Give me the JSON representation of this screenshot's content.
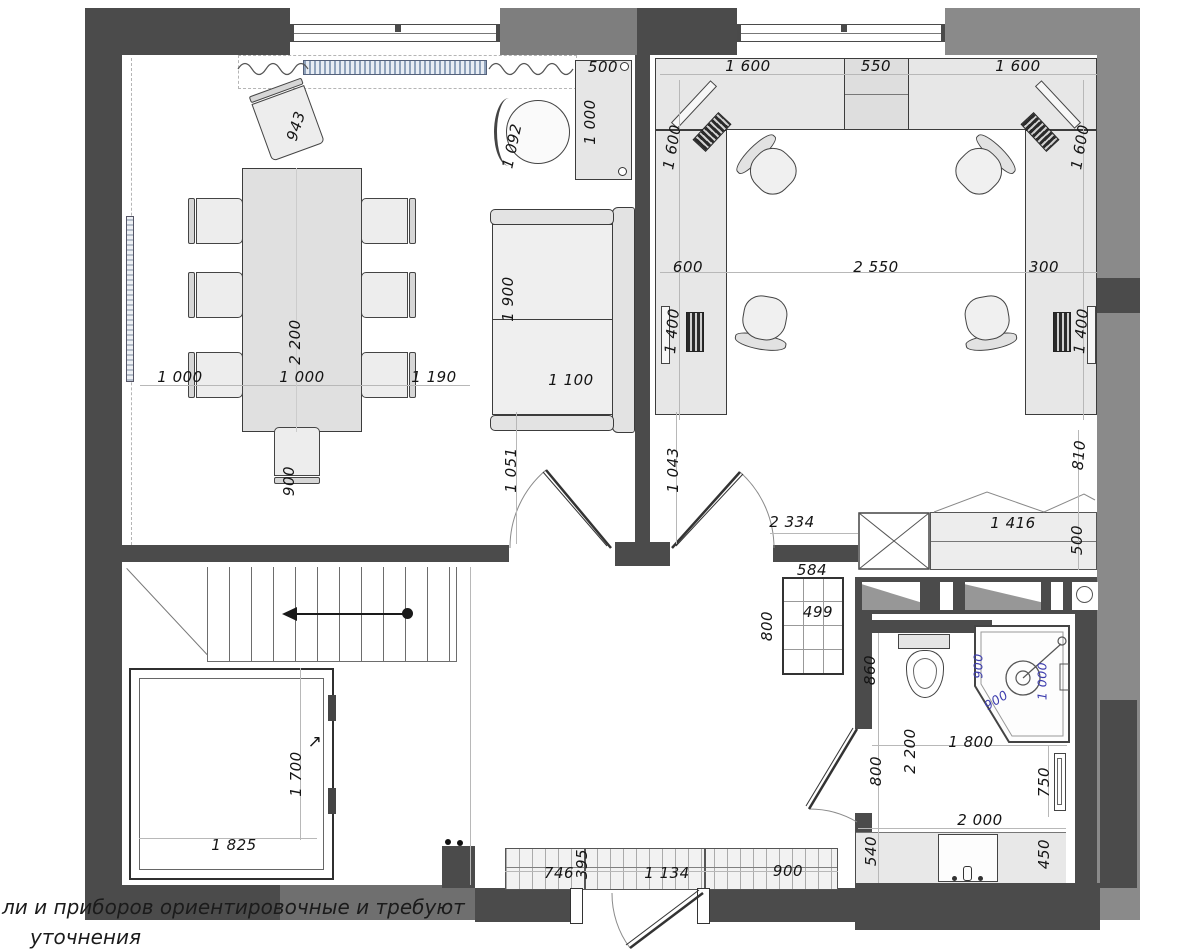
{
  "note": {
    "line1": "ли  и приборов ориентировочные  и требуют",
    "line2": "уточнения"
  },
  "colors": {
    "wall_dark": "#4b4b4b",
    "wall_gray": "#8a8a8a",
    "dim_text": "#141414",
    "dim_blue": "#3d3dae",
    "radiator_fill": "#8fa2bb",
    "furniture_fill": "#e9e9e9"
  },
  "icons": {
    "stairs_direction_icon": "left-arrow-with-dot",
    "elevator_direction_icon": "up-right-arrow"
  },
  "labels": [
    {
      "text": "943",
      "x": 296,
      "y": 126,
      "rot": -72
    },
    {
      "text": "1 092",
      "x": 512,
      "y": 146,
      "rot": -78
    },
    {
      "text": "500",
      "x": 603,
      "y": 67,
      "rot": 0
    },
    {
      "text": "1 000",
      "x": 590,
      "y": 122,
      "rot": -90
    },
    {
      "text": "2 200",
      "x": 295,
      "y": 342,
      "rot": -90
    },
    {
      "text": "1 000",
      "x": 180,
      "y": 377,
      "rot": 0
    },
    {
      "text": "1 000",
      "x": 302,
      "y": 377,
      "rot": 0
    },
    {
      "text": "1 190",
      "x": 434,
      "y": 377,
      "rot": 0
    },
    {
      "text": "1 900",
      "x": 508,
      "y": 299,
      "rot": -90
    },
    {
      "text": "1 100",
      "x": 571,
      "y": 380,
      "rot": 0
    },
    {
      "text": "900",
      "x": 289,
      "y": 481,
      "rot": -90
    },
    {
      "text": "1 051",
      "x": 511,
      "y": 470,
      "rot": -90
    },
    {
      "text": "1 043",
      "x": 673,
      "y": 470,
      "rot": -90
    },
    {
      "text": "1 600",
      "x": 748,
      "y": 66,
      "rot": 0
    },
    {
      "text": "550",
      "x": 876,
      "y": 66,
      "rot": 0
    },
    {
      "text": "1 600",
      "x": 1018,
      "y": 66,
      "rot": 0
    },
    {
      "text": "1 600",
      "x": 672,
      "y": 147,
      "rot": -80
    },
    {
      "text": "1 600",
      "x": 1080,
      "y": 147,
      "rot": -80
    },
    {
      "text": "600",
      "x": 688,
      "y": 267,
      "rot": 0
    },
    {
      "text": "2 550",
      "x": 876,
      "y": 267,
      "rot": 0
    },
    {
      "text": "300",
      "x": 1044,
      "y": 267,
      "rot": 0
    },
    {
      "text": "1 400",
      "x": 672,
      "y": 331,
      "rot": -85
    },
    {
      "text": "1 400",
      "x": 1081,
      "y": 331,
      "rot": -85
    },
    {
      "text": "810",
      "x": 1079,
      "y": 455,
      "rot": -85
    },
    {
      "text": "2 334",
      "x": 792,
      "y": 522,
      "rot": 0
    },
    {
      "text": "1 416",
      "x": 1013,
      "y": 523,
      "rot": 0
    },
    {
      "text": "500",
      "x": 1077,
      "y": 540,
      "rot": -90
    },
    {
      "text": "584",
      "x": 812,
      "y": 570,
      "rot": 0
    },
    {
      "text": "499",
      "x": 818,
      "y": 612,
      "rot": 0
    },
    {
      "text": "800",
      "x": 767,
      "y": 626,
      "rot": -90
    },
    {
      "text": "860",
      "x": 870,
      "y": 670,
      "rot": -90
    },
    {
      "text": "900",
      "x": 978,
      "y": 666,
      "rot": -90,
      "color": "blue"
    },
    {
      "text": "1 000",
      "x": 1042,
      "y": 681,
      "rot": -90,
      "color": "blue"
    },
    {
      "text": "900",
      "x": 996,
      "y": 700,
      "rot": -32,
      "color": "blue"
    },
    {
      "text": "2 200",
      "x": 910,
      "y": 751,
      "rot": -90
    },
    {
      "text": "1 800",
      "x": 971,
      "y": 742,
      "rot": 0
    },
    {
      "text": "800",
      "x": 876,
      "y": 771,
      "rot": -90
    },
    {
      "text": "750",
      "x": 1044,
      "y": 782,
      "rot": -90
    },
    {
      "text": "2 000",
      "x": 980,
      "y": 820,
      "rot": 0
    },
    {
      "text": "540",
      "x": 871,
      "y": 851,
      "rot": -90
    },
    {
      "text": "450",
      "x": 1044,
      "y": 854,
      "rot": -90
    },
    {
      "text": "1 700",
      "x": 296,
      "y": 774,
      "rot": -90
    },
    {
      "text": "↗",
      "x": 315,
      "y": 742,
      "rot": 0,
      "size": 17
    },
    {
      "text": "1 825",
      "x": 234,
      "y": 845,
      "rot": 0
    },
    {
      "text": "746",
      "x": 559,
      "y": 873,
      "rot": 0
    },
    {
      "text": "395",
      "x": 582,
      "y": 864,
      "rot": -90
    },
    {
      "text": "1 134",
      "x": 667,
      "y": 873,
      "rot": 0
    },
    {
      "text": "900",
      "x": 788,
      "y": 871,
      "rot": 0
    }
  ]
}
